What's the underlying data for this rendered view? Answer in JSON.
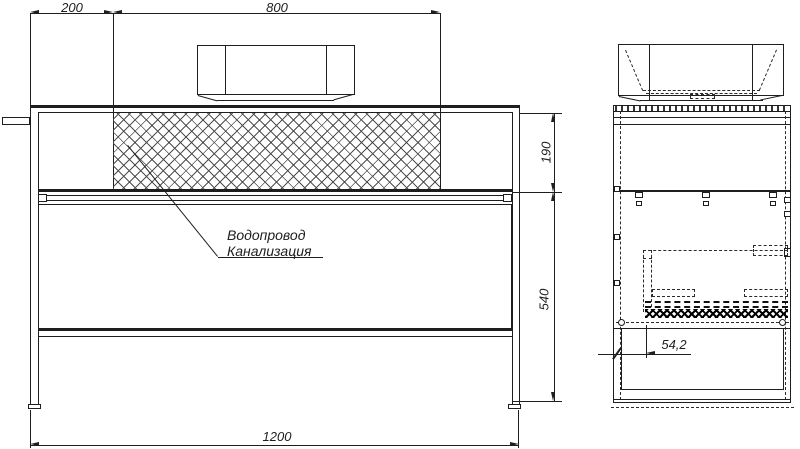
{
  "drawing": {
    "type": "technical-drawing-vanity-console",
    "labels": {
      "water": "Водопровод",
      "sewer": "Канализация"
    },
    "dimensions": {
      "d200": "200",
      "d800": "800",
      "d190": "190",
      "d540": "540",
      "d1200": "1200",
      "d54_2": "54,2"
    },
    "colors": {
      "line": "#1e1e1e",
      "background": "#ffffff"
    }
  }
}
